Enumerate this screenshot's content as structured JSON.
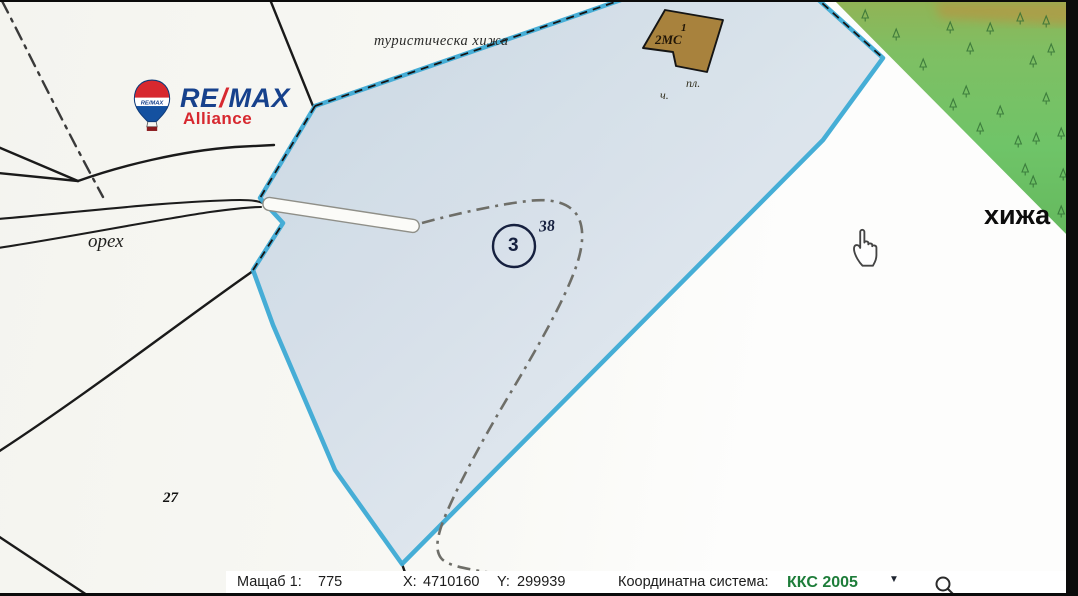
{
  "branding": {
    "re": "RE",
    "slash": "/",
    "max": "MAX",
    "alliance": "Alliance",
    "balloon_text": "RE/MAX"
  },
  "map": {
    "labels": {
      "tourist_lodge": "туристическа хижа",
      "walnut": "орех",
      "lodge": "хижа",
      "parcel_circle": "3",
      "parcel_code": "38",
      "neighbor_parcel": "27",
      "building_code": "2МС",
      "building_mark": "1",
      "abbr_pl": "пл.",
      "abbr_ch": "ч."
    }
  },
  "toolbar": {
    "scale_label": "Мащаб 1:",
    "scale_value": "775",
    "x_label": "X:",
    "x_value": "4710160",
    "y_label": "Y:",
    "y_value": "299939",
    "crs_label": "Координатна система:",
    "crs_value": "ККС 2005",
    "dropdown_glyph": "▼"
  },
  "colors": {
    "parcel-stroke": "#3fabd5",
    "parcel-fill-light": "#eaf0f5",
    "parcel-fill-dark": "#c9d6e3",
    "forest-green": "#6fc468",
    "forest-olive": "#93b254",
    "forest-band-orange": "#c68a3a",
    "forest-tree": "#2f6d33",
    "building-brown": "#a8823d",
    "remax-blue": "#16418c",
    "remax-red": "#d7282f",
    "crs-green": "#1e7d3a",
    "navy-ink": "#16203f",
    "line-black": "#1a1a1a",
    "dash-gray": "#6e6e68"
  }
}
